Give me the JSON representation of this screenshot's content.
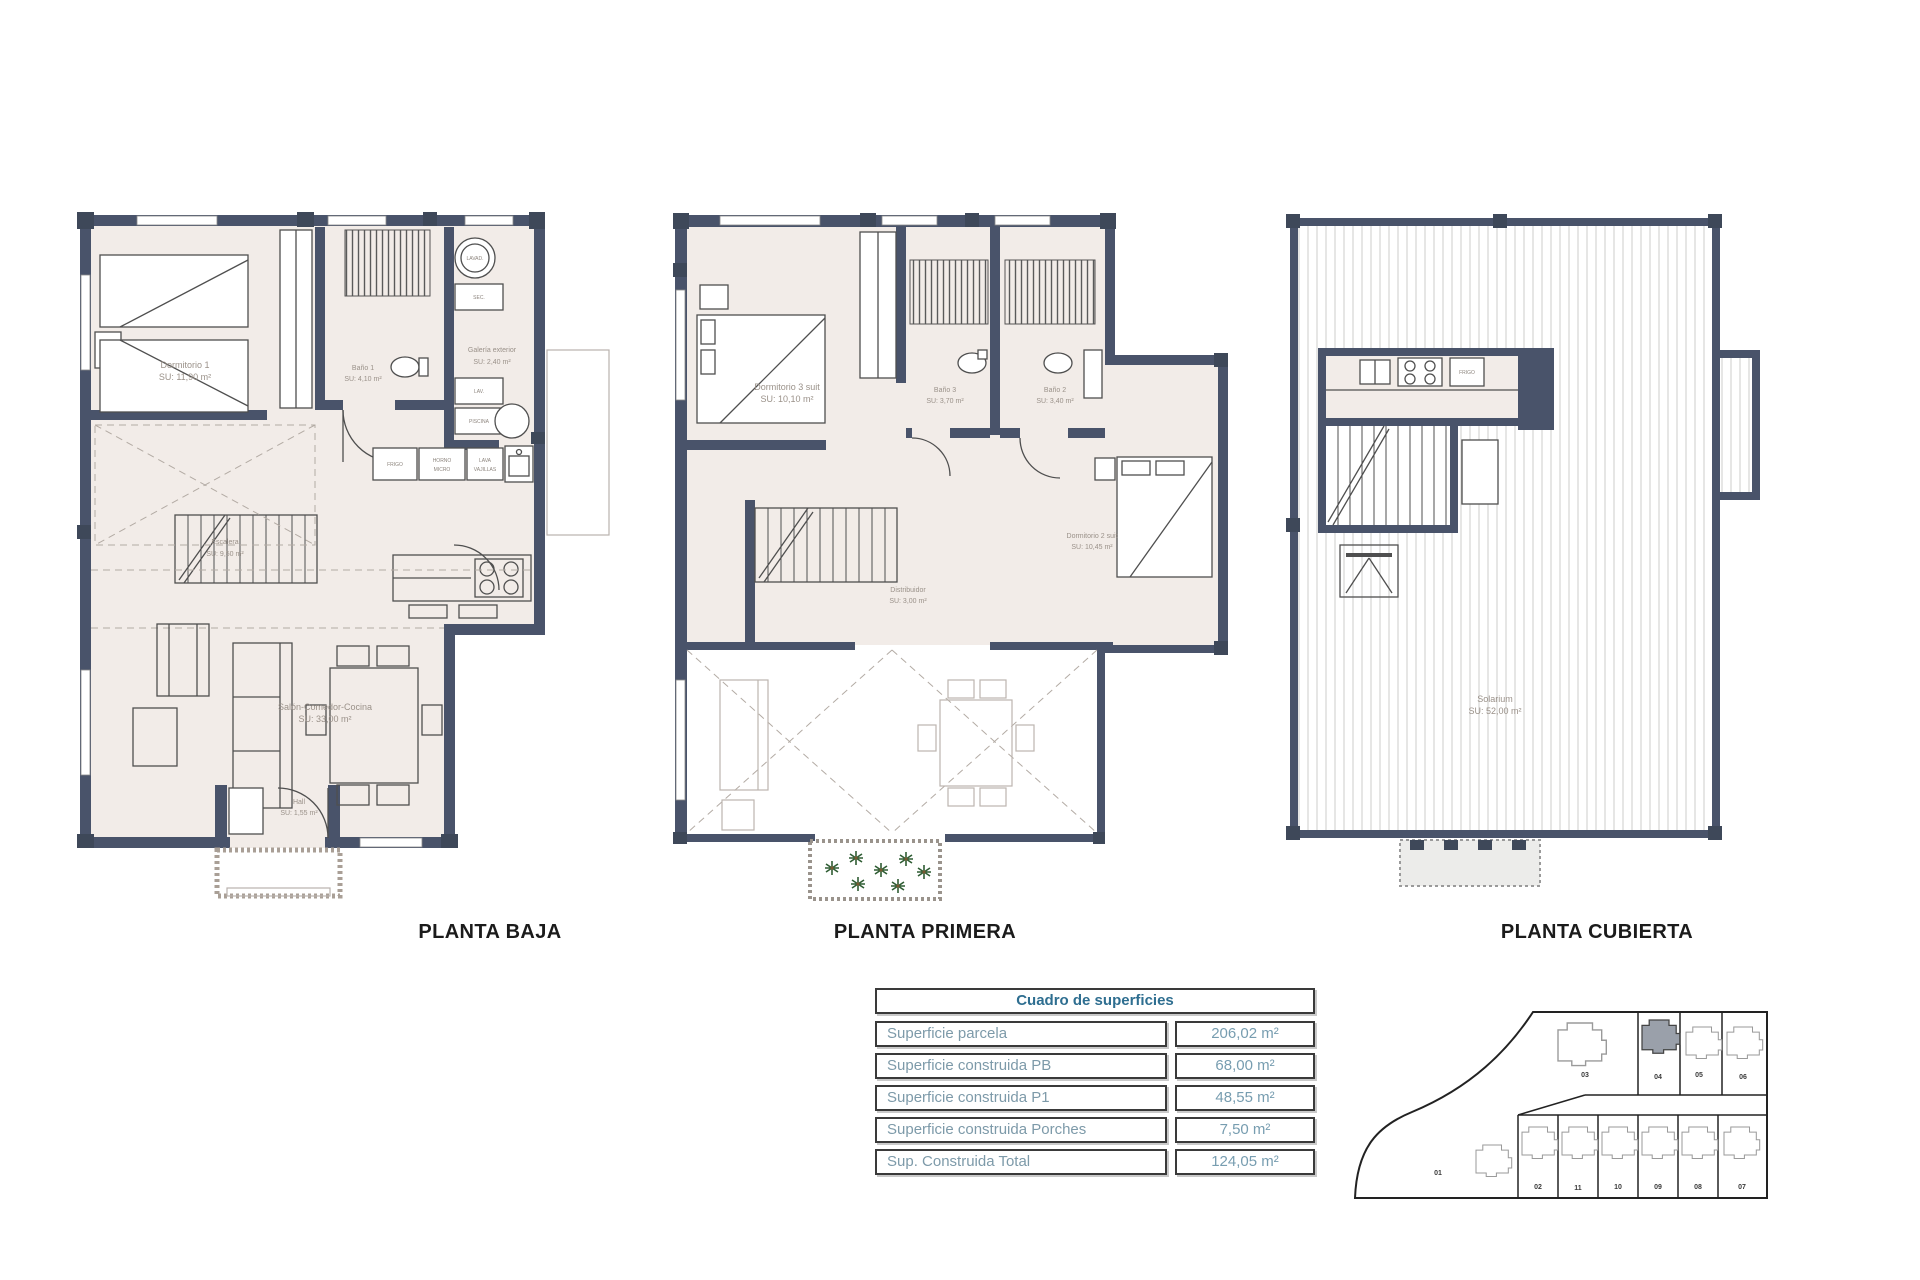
{
  "titles": {
    "plan1": "PLANTA BAJA",
    "plan2": "PLANTA PRIMERA",
    "plan3": "PLANTA CUBIERTA"
  },
  "plans": {
    "planta_baja": {
      "rooms": {
        "dormitorio1": {
          "name": "Dormitorio 1",
          "area": "SU: 11,90 m²"
        },
        "bano1": {
          "name": "Baño 1",
          "area": "SU: 4,10 m²"
        },
        "escalera": {
          "name": "Escalera",
          "area": "SU: 9,50 m²"
        },
        "salon": {
          "name": "Salón-Comedor-Cocina",
          "area": "SU: 33,00 m²"
        },
        "hall": {
          "name": "Hall",
          "area": "SU: 1,55 m²"
        }
      },
      "galeria": {
        "name": "Galería exterior",
        "area": "SU: 2,40 m²",
        "washer": "LAVAD.",
        "dryer": "SEC.",
        "sink": "LAV.",
        "boiler": "PISCINA"
      },
      "appliances": {
        "fridge": "FRIGO",
        "oven_line1": "HORNO",
        "oven_line2": "MICRO",
        "dw_line1": "LAVA",
        "dw_line2": "VAJILLAS"
      }
    },
    "planta_primera": {
      "rooms": {
        "dormitorio3": {
          "name": "Dormitorio 3 suit",
          "area": "SU: 10,10 m²"
        },
        "bano3": {
          "name": "Baño 3",
          "area": "SU: 3,70 m²"
        },
        "bano2": {
          "name": "Baño 2",
          "area": "SU: 3,40 m²"
        },
        "dormitorio2": {
          "name": "Dormitorio 2 suit",
          "area": "SU: 10,45 m²"
        },
        "distribuidor": {
          "name": "Distribuidor",
          "area": "SU: 3,00 m²"
        }
      }
    },
    "planta_cubierta": {
      "rooms": {
        "solarium": {
          "name": "Solarium",
          "area": "SU: 52,00 m²"
        }
      },
      "appliances": {
        "fridge": "FRIGO"
      }
    }
  },
  "table": {
    "header": "Cuadro de superficies",
    "rows": [
      {
        "label": "Superficie parcela",
        "value": "206,02 m²"
      },
      {
        "label": "Superficie construida PB",
        "value": "68,00 m²"
      },
      {
        "label": "Superficie construida P1",
        "value": "48,55 m²"
      },
      {
        "label": "Superficie construida Porches",
        "value": "7,50 m²"
      },
      {
        "label": "Sup. Construida Total",
        "value": "124,05 m²"
      }
    ]
  },
  "site_plan": {
    "plots": {
      "p01": "01",
      "p02": "02",
      "p03": "03",
      "p04": "04",
      "p05": "05",
      "p06": "06",
      "p07": "07",
      "p08": "08",
      "p09": "09",
      "p10": "10",
      "p11": "11"
    },
    "highlighted_plot": "04"
  },
  "colors": {
    "wall": "#49536a",
    "floor": "#f2ece8",
    "table_header_text": "#2e6e90",
    "table_row_text": "#7d9aa9",
    "highlight_plot_fill": "#9aa0aa",
    "plant_green": "#2f5d33"
  }
}
